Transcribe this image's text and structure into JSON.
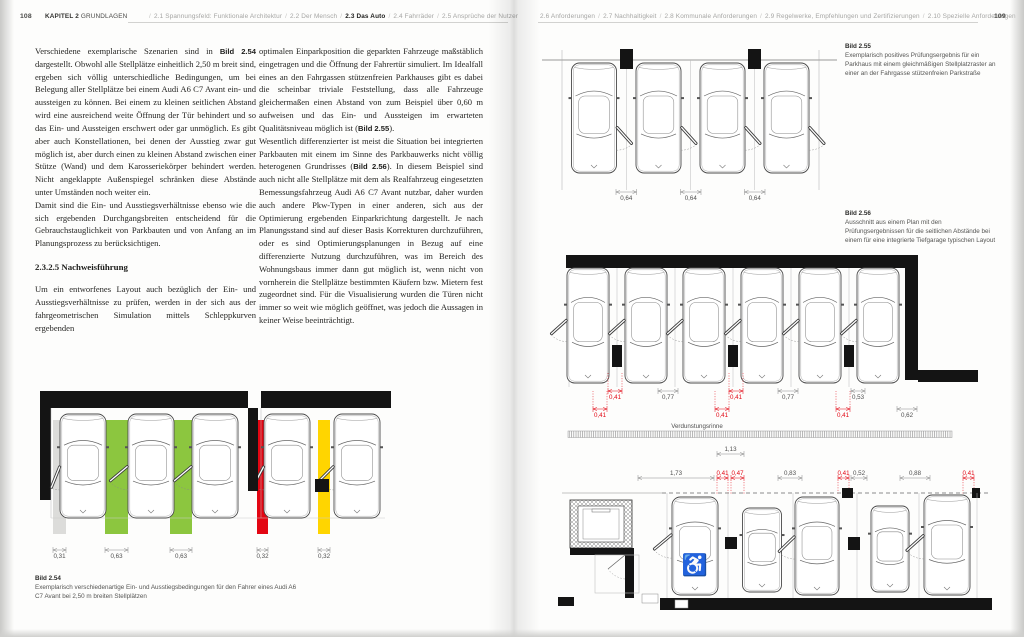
{
  "header_left": {
    "page_number": "108",
    "chapter_label": "KAPITEL 2",
    "chapter_title": "GRUNDLAGEN",
    "nav_items": [
      {
        "label": "2.1 Spannungsfeld: Funktionale Architektur",
        "active": false
      },
      {
        "label": "2.2 Der Mensch",
        "active": false
      },
      {
        "label": "2.3 Das Auto",
        "active": true
      },
      {
        "label": "2.4 Fahrräder",
        "active": false
      },
      {
        "label": "2.5 Ansprüche der Nutzer",
        "active": false
      }
    ]
  },
  "header_right": {
    "page_number": "109",
    "nav_items": [
      {
        "label": "2.6 Anforderungen",
        "active": false
      },
      {
        "label": "2.7 Nachhaltigkeit",
        "active": false
      },
      {
        "label": "2.8 Kommunale Anforderungen",
        "active": false
      },
      {
        "label": "2.9 Regelwerke, Empfehlungen und Zertifizierungen",
        "active": false
      },
      {
        "label": "2.10 Spezielle Anforderungen",
        "active": false
      }
    ]
  },
  "article": {
    "col1": {
      "p1": [
        {
          "t": "Verschiedene exemplarische Szenarien sind in "
        },
        {
          "t": "Bild 2.54",
          "b": true
        },
        {
          "t": " dargestellt. Obwohl alle Stellplätze einheitlich 2,50 m breit sind, ergeben sich völlig unterschiedliche Bedingungen, um bei Belegung aller Stellplätze bei einem Audi A6 C7 Avant ein- und aussteigen zu können. Bei einem zu kleinen seitlichen Abstand wird eine ausreichend weite Öffnung der Tür behindert und so das Ein- und Aussteigen erschwert oder gar unmöglich. Es gibt aber auch Konstellationen, bei denen der Ausstieg zwar gut möglich ist, aber durch einen zu kleinen Abstand zwischen einer Stütze (Wand) und dem Karosseriekörper behindert werden. Nicht angeklappte Außenspiegel schränken diese Abstände unter Umständen noch weiter ein."
        }
      ],
      "p2": [
        {
          "t": "Damit sind die Ein- und Ausstiegsverhältnisse ebenso wie die sich ergebenden Durchgangsbreiten entscheidend für die Gebrauchstauglichkeit von Parkbauten und von Anfang an im Planungsprozess zu berücksichtigen."
        }
      ],
      "heading": "2.3.2.5 Nachweisführung",
      "p3": [
        {
          "t": "Um ein entworfenes Layout auch bezüglich der Ein- und Ausstiegsverhältnisse zu prüfen, werden in der sich aus der fahrgeometrischen Simulation mittels Schleppkurven ergebenden"
        }
      ]
    },
    "col2": {
      "p1": [
        {
          "t": "optimalen Einparkposition die geparkten Fahrzeuge maßstäblich eingetragen und die Öffnung der Fahrertür simuliert. Im Idealfall eines an den Fahrgassen stützenfreien Parkhauses gibt es dabei die scheinbar triviale Feststellung, dass alle Fahrzeuge gleichermaßen einen Abstand von zum Beispiel über 0,60 m aufweisen und das Ein- und Aussteigen im erwarteten Qualitätsniveau möglich ist ("
        },
        {
          "t": "Bild 2.55",
          "b": true
        },
        {
          "t": ")."
        }
      ],
      "p2": [
        {
          "t": "Wesentlich differenzierter ist meist die Situation bei integrierten Parkbauten mit einem im Sinne des Parkbauwerks nicht völlig heterogenen Grundrisses ("
        },
        {
          "t": "Bild 2.56",
          "b": true
        },
        {
          "t": "). In diesem Beispiel sind auch nicht alle Stellplätze mit dem als Realfahrzeug eingesetzten Bemessungsfahrzeug Audi A6 C7 Avant nutzbar, daher wurden auch andere Pkw-Typen in einer anderen, sich aus der Optimierung ergebenden Einparkrichtung dargestellt. Je nach Planungsstand sind auf dieser Basis Korrekturen durchzuführen, oder es sind Optimierungsplanungen in Bezug auf eine differenzierte Nutzung durchzuführen, was im Bereich des Wohnungsbaus immer dann gut möglich ist, wenn nicht von vornherein die Stellplätze bestimmten Käufern bzw. Mietern fest zugeordnet sind. Für die Visualisierung wurden die Türen nicht immer so weit wie möglich geöffnet, was jedoch die Aussagen in keiner Weise beeinträchtigt."
        }
      ]
    }
  },
  "figures": {
    "fig254": {
      "caption_title": "Bild 2.54",
      "caption_text": "Exemplarisch verschiedenartige Ein- und Ausstiegsbedingungen für den Fahrer eines Audi A6 C7 Avant bei 2,50 m breiten Stellplätzen",
      "bars": [
        {
          "value": "0,31",
          "color": "#dcdcda"
        },
        {
          "value": "0,63",
          "color": "#8cc63f"
        },
        {
          "value": "0,63",
          "color": "#8cc63f"
        },
        {
          "value": "0,32",
          "color": "#e30613"
        },
        {
          "value": "0,32",
          "color": "#ffd500"
        }
      ]
    },
    "fig255": {
      "caption_title": "Bild 2.55",
      "caption_text": "Exemplarisch positives Prüfungsergebnis für ein Parkhaus mit einem gleichmäßigen Stellplatzraster an einer an der Fahrgasse stützenfreien Parkstraße",
      "dims": [
        "0,64",
        "0,64",
        "0,64"
      ]
    },
    "fig256": {
      "caption_title": "Bild 2.56",
      "caption_text": "Ausschnitt aus einem Plan mit den Prüfungsergebnissen für die seitlichen Abstände bei einem für eine integrierte Tiefgarage typischen Layout",
      "dims_row1": [
        {
          "value": "0,41",
          "red": true
        },
        {
          "value": "0,77",
          "red": false
        },
        {
          "value": "0,41",
          "red": true
        },
        {
          "value": "0,77",
          "red": false
        },
        {
          "value": "0,53",
          "red": false
        }
      ],
      "dims_row2": [
        {
          "value": "0,41",
          "red": true
        },
        {
          "value": "0,41",
          "red": true
        },
        {
          "value": "0,41",
          "red": true
        },
        {
          "value": "0,62",
          "red": false
        }
      ],
      "gutter_label": "Verdunstungsrinne"
    },
    "figbottom": {
      "dim_top": "1,13",
      "dims": [
        {
          "value": "1,73",
          "red": false
        },
        {
          "value": "0,41",
          "red": true
        },
        {
          "value": "0,47",
          "red": true
        },
        {
          "value": "0,83",
          "red": false
        },
        {
          "value": "0,41",
          "red": true
        },
        {
          "value": "0,52",
          "red": false
        },
        {
          "value": "0,88",
          "red": false
        },
        {
          "value": "0,41",
          "red": true
        }
      ]
    }
  },
  "icons": {
    "accessibility": "♿"
  },
  "colors": {
    "red": "#e30613",
    "green": "#8cc63f",
    "yellow": "#ffd500",
    "gray_bar": "#dcdcda",
    "wall": "#141414"
  }
}
